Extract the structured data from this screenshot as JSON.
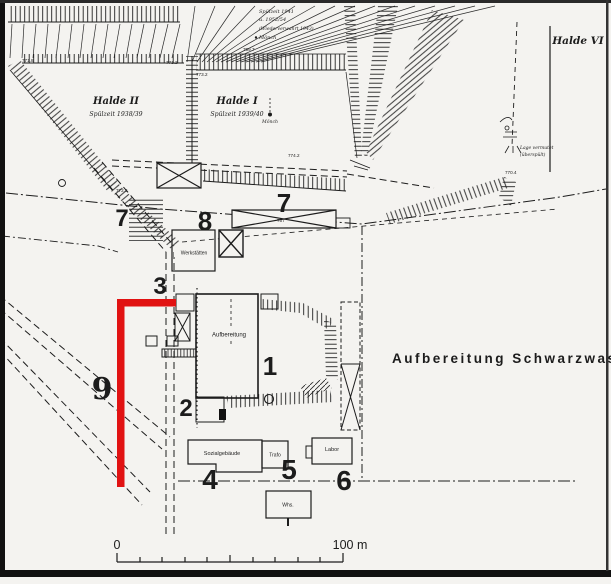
{
  "map": {
    "site_label": "Aufbereitung  Schwarzwasser",
    "halde2_name": "Halde II",
    "halde2_period": "Spülzeit 1938/39",
    "halde1_name": "Halde I",
    "halde1_period": "Spülzeit 1939/40",
    "halde6_name": "Halde VI",
    "note_tr_1": "Spülzeit 1941",
    "note_tr_2": "u. 1952/54",
    "note_tr_3": "(Wiederverwahrt 1943)",
    "note_tr_4": "Mönch",
    "moench_label": "Mönch",
    "halde6_note_1": "Lage vermutet",
    "halde6_note_2": "(überspült)"
  },
  "markers": {
    "m1": "1",
    "m2": "2",
    "m3": "3",
    "m4": "4",
    "m5": "5",
    "m6": "6",
    "m7_left": "7",
    "m7_center": "7",
    "m8": "8",
    "m9": "9"
  },
  "buildings": {
    "aufbereitung": "Aufbereitung",
    "werkstaetten": "Werkstätten",
    "sozialgebaeude": "Sozialgebäude",
    "trafo": "Trafo",
    "labor": "Labor",
    "whs": "Whs."
  },
  "elevations": [
    "771.8",
    "771.2",
    "773.2",
    "759.7",
    "774.2",
    "772.6",
    "757",
    "770.4"
  ],
  "scale_bar": {
    "start": "0",
    "end": "100 m"
  },
  "colors": {
    "highlight_red": "#e11212",
    "ink": "#1c1c1c",
    "paper": "#f4f3f0"
  }
}
